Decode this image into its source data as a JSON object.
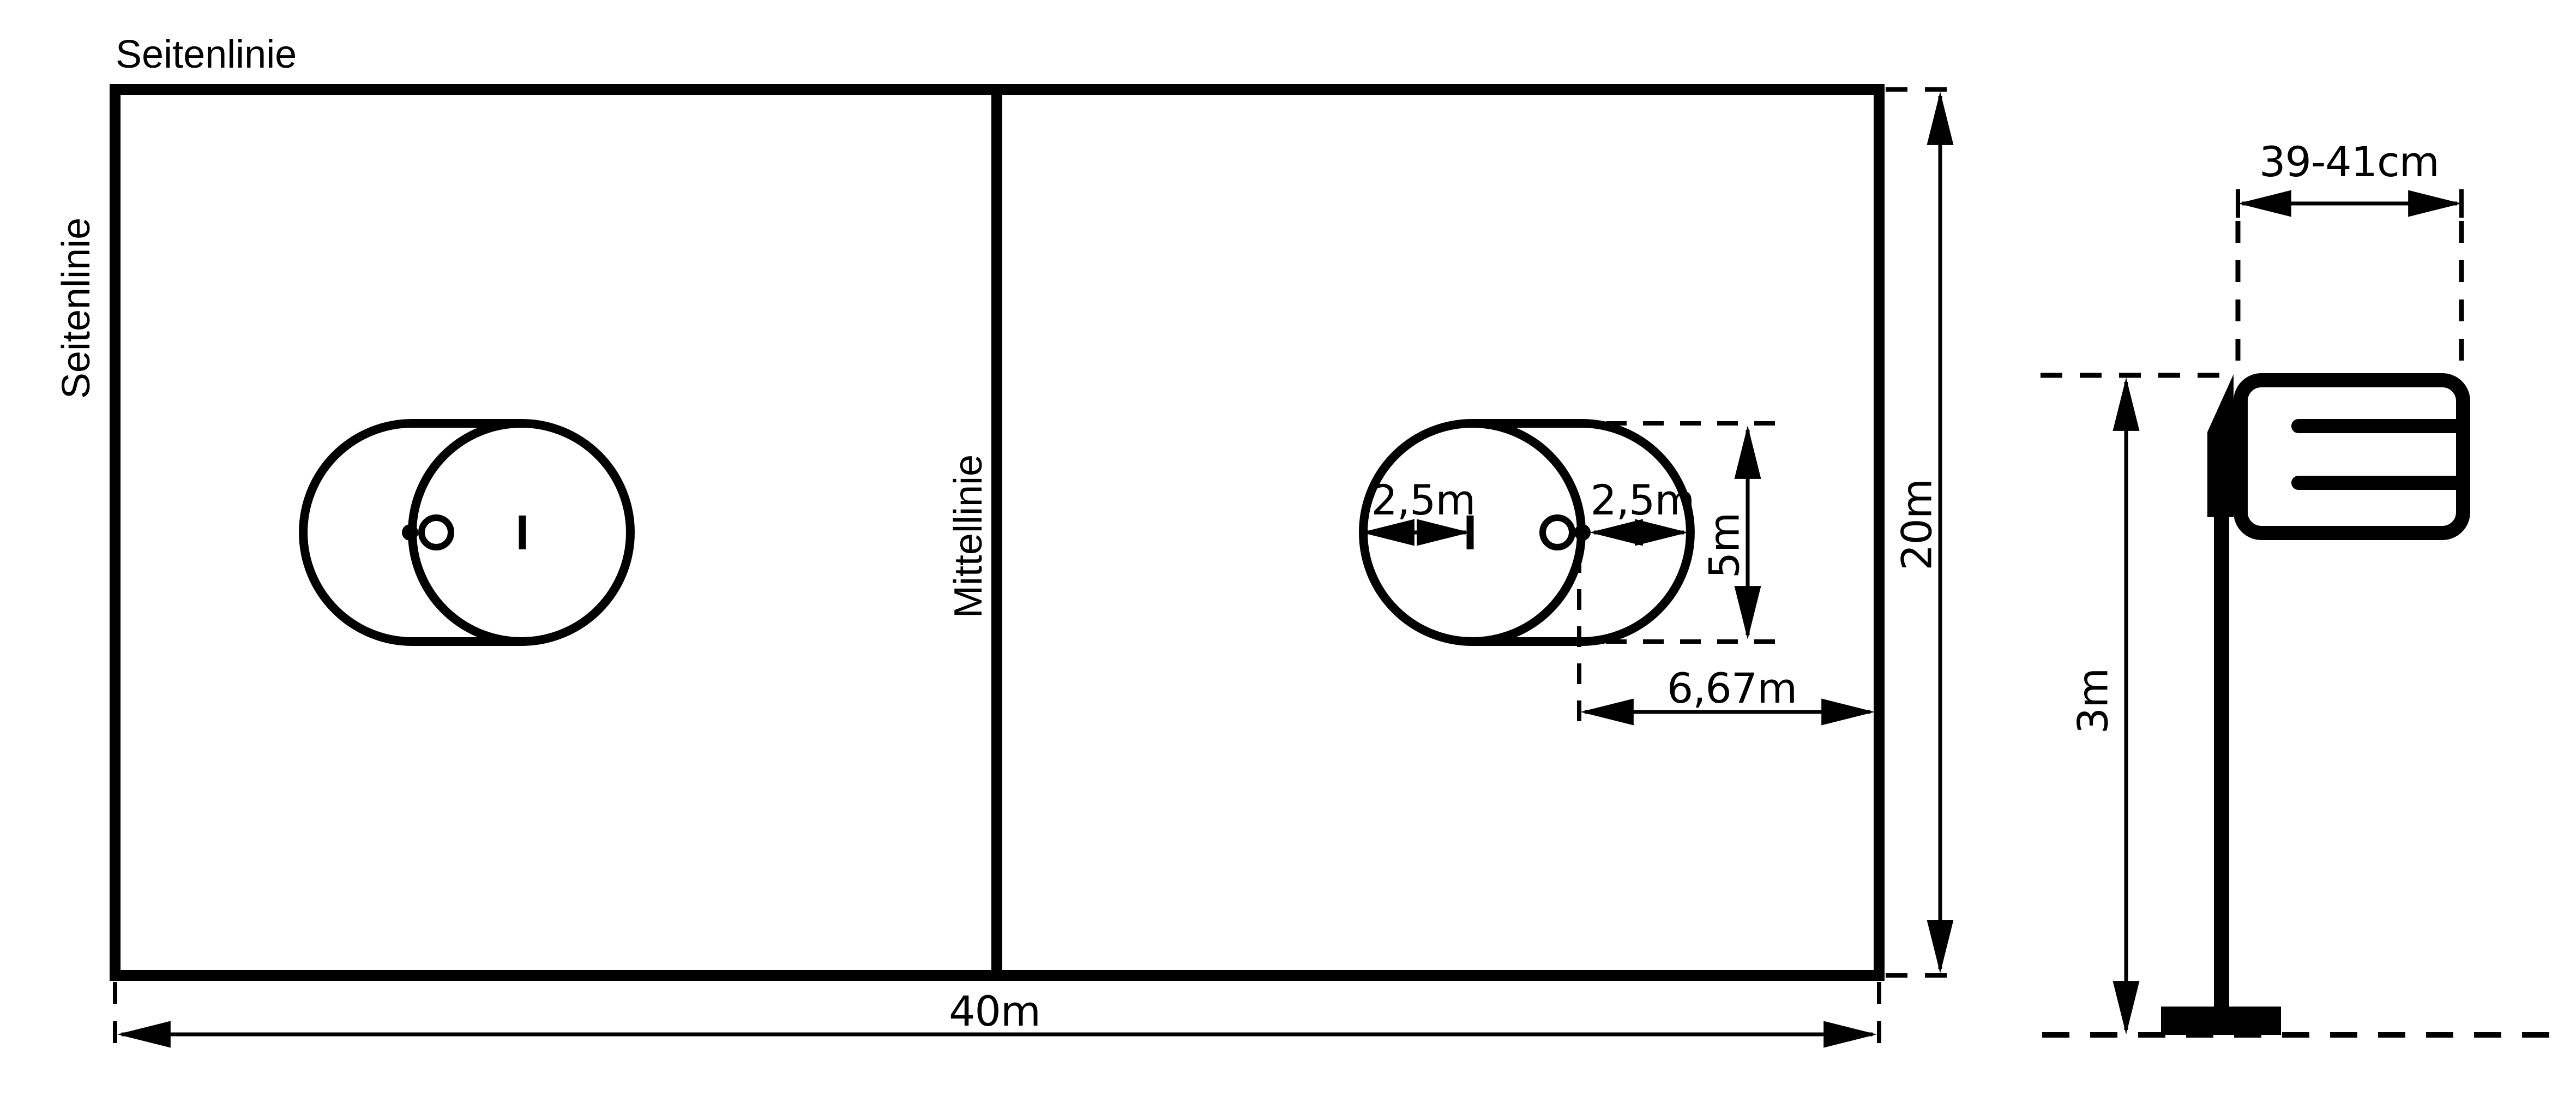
{
  "colors": {
    "ink": "#000000",
    "background": "#ffffff"
  },
  "field": {
    "sideline_label_top": "Seitenlinie",
    "sideline_label_left": "Seitenlinie",
    "center_line_label": "Mittellinie",
    "length_label": "40m",
    "width_label": "20m"
  },
  "target_area": {
    "circle_radius_label": "2,5m",
    "end_radius_label": "2,5m",
    "height_label": "5m",
    "post_distance_label": "6,67m"
  },
  "basket_post": {
    "basket_width_label": "39-41cm",
    "post_height_label": "3m"
  }
}
